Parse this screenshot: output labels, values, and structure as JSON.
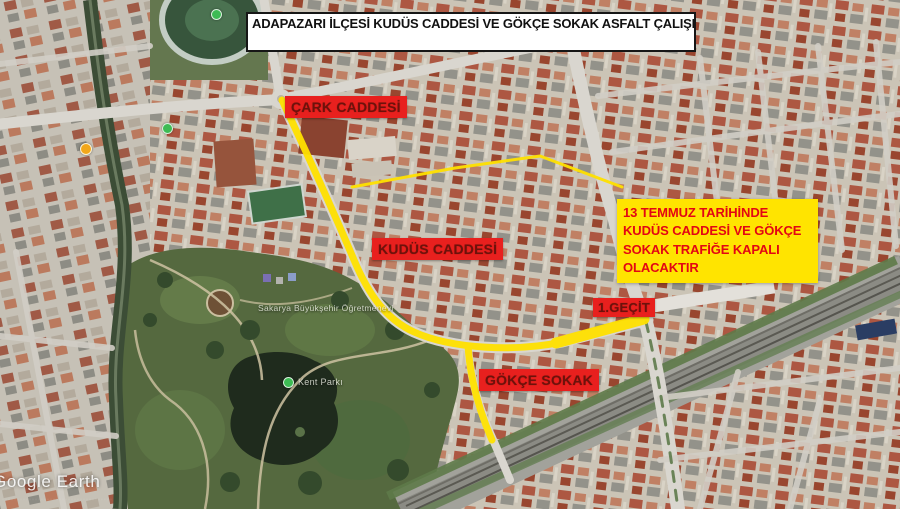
{
  "title": "ADAPAZARI İLÇESİ KUDÜS CADDESİ VE GÖKÇE SOKAK ASFALT ÇALIŞMASI",
  "street_labels": {
    "cark": "ÇARK CADDESİ",
    "kudus": "KUDÜS CADDESİ",
    "gecit": "1.GEÇİT",
    "gokce": "GÖKÇE SOKAK"
  },
  "notice": "13 TEMMUZ TARİHİNDE KUDÜS CADDESİ VE GÖKÇE SOKAK TRAFİĞE KAPALI OLACAKTIR",
  "watermark": "Google Earth",
  "poi_labels": {
    "teacher_house": "Sakarya Büyükşehir Öğretmenevi",
    "park": "Kent Parkı"
  },
  "colors": {
    "route_highlight": "#FFE100",
    "street_label_bg": "#E8201E",
    "street_label_text": "#6D120B",
    "notice_bg": "#FFE400",
    "notice_text": "#E30613",
    "title_bg": "#FFFFFF",
    "title_text": "#111111",
    "park_green": "#55693F",
    "lake_dark": "#1F2B1D"
  }
}
